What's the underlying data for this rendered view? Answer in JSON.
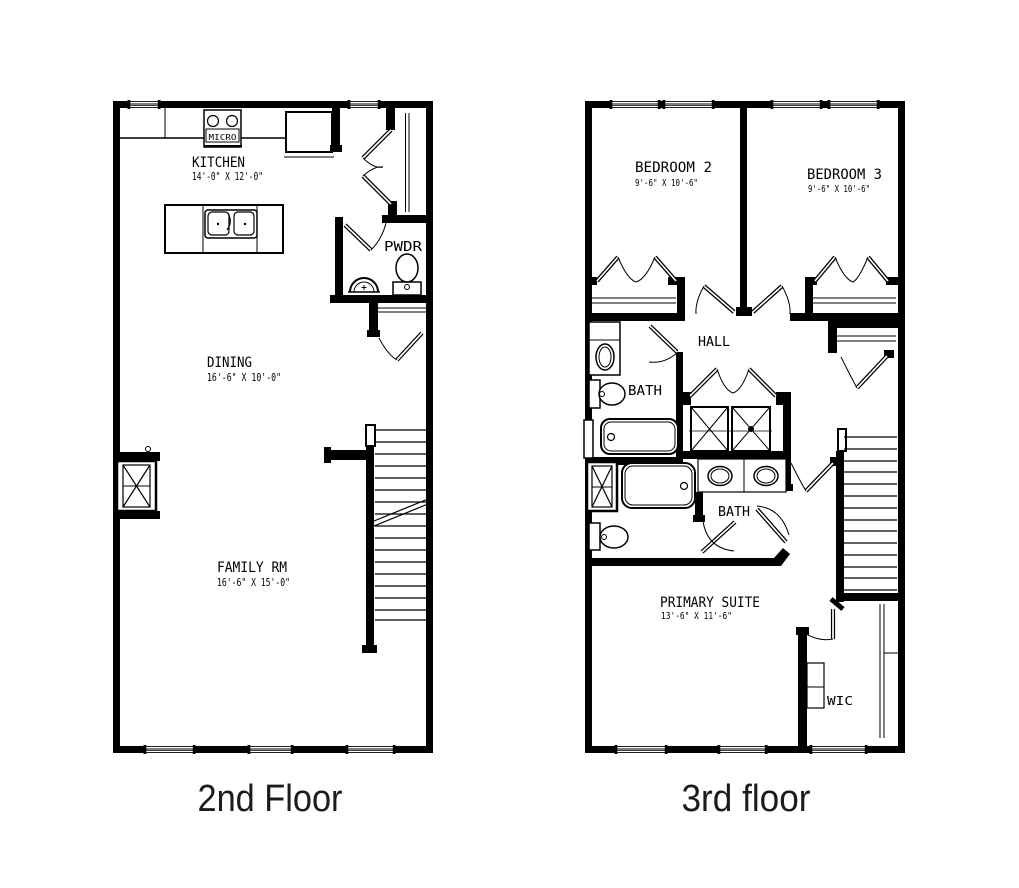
{
  "page": {
    "background": "#ffffff",
    "line_color": "#000000"
  },
  "floor2": {
    "caption": "2nd Floor",
    "kitchen_label": "KITCHEN",
    "kitchen_dims": "14'-0\" X 12'-0\"",
    "micro_label": "MICRO",
    "powder_label": "PWDR",
    "dining_label": "DINING",
    "dining_dims": "16'-6\" X 10'-0\"",
    "family_label": "FAMILY RM",
    "family_dims": "16'-6\" X 15'-0\""
  },
  "floor3": {
    "caption": "3rd floor",
    "bedroom2_label": "BEDROOM 2",
    "bedroom2_dims": "9'-6\" X 10'-6\"",
    "bedroom3_label": "BEDROOM 3",
    "bedroom3_dims": "9'-6\" X 10'-6\"",
    "hall_label": "HALL",
    "bath_upper_label": "BATH",
    "bath_primary_label": "BATH",
    "primary_label": "PRIMARY SUITE",
    "primary_dims": "13'-6\" X 11'-6\"",
    "wic_label": "WIC"
  }
}
